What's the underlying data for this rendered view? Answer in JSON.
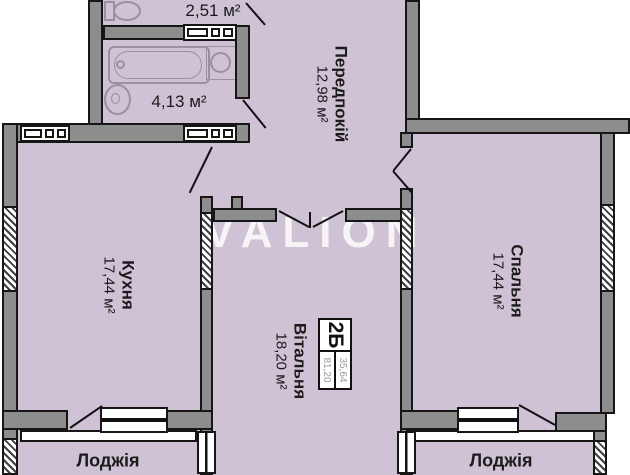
{
  "watermark": {
    "text": "VALION"
  },
  "unit_badge": {
    "code": "2Б",
    "living_area": "35,64",
    "total_area": "81,20"
  },
  "rooms": {
    "wc": {
      "area": "2,51 м²"
    },
    "bathroom": {
      "area": "4,13 м²"
    },
    "hallway": {
      "name": "Передпокій",
      "area": "12,98 м²"
    },
    "kitchen": {
      "name": "Кухня",
      "area": "17,44 м²"
    },
    "bedroom": {
      "name": "Спальня",
      "area": "17,44 м²"
    },
    "living_room": {
      "name": "Вітальня",
      "area": "18,20 м²"
    },
    "loggia_left": {
      "name": "Лоджія"
    },
    "loggia_right": {
      "name": "Лоджія"
    }
  },
  "colors": {
    "room_fill": "#cfc2d4",
    "wall": "#8d8d8d",
    "outline": "#161616",
    "watermark": "#ffffff"
  }
}
